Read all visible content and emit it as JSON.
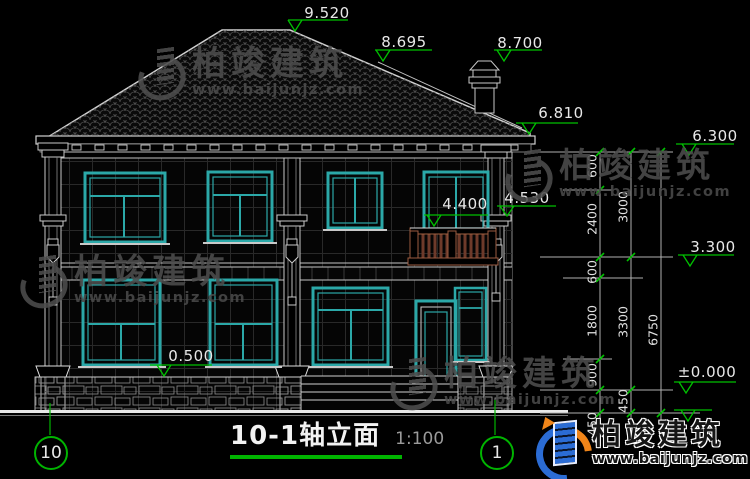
{
  "drawing": {
    "title": "10-1轴立面",
    "scale": "1:100"
  },
  "axis_markers": [
    "10",
    "1"
  ],
  "level_annotations": [
    "9.520",
    "8.695",
    "8.700",
    "6.810",
    "6.300",
    "4.530",
    "4.400",
    "3.300",
    "0.500",
    "±0.000"
  ],
  "dimensions": {
    "chain_inner": [
      "600",
      "2400",
      "600",
      "1800",
      "900",
      "450"
    ],
    "chain_middle": [
      "3000",
      "3300",
      "450"
    ],
    "chain_outer": [
      "6750"
    ]
  },
  "watermark": {
    "company": "柏竣建筑",
    "website": "www.baijunjz.com"
  },
  "footer_logo": {
    "company": "柏竣建筑",
    "website": "www.baijunjz.com"
  },
  "colors": {
    "background": "#000000",
    "line_white": "#d8d8d8",
    "window_teal": "#2ba8a8",
    "dimension_green": "#00c000",
    "railing_brown": "#6e3a2a",
    "watermark_gray": "#4d4d4d",
    "logo_blue": "#2b6cd4",
    "logo_orange": "#f08519"
  }
}
